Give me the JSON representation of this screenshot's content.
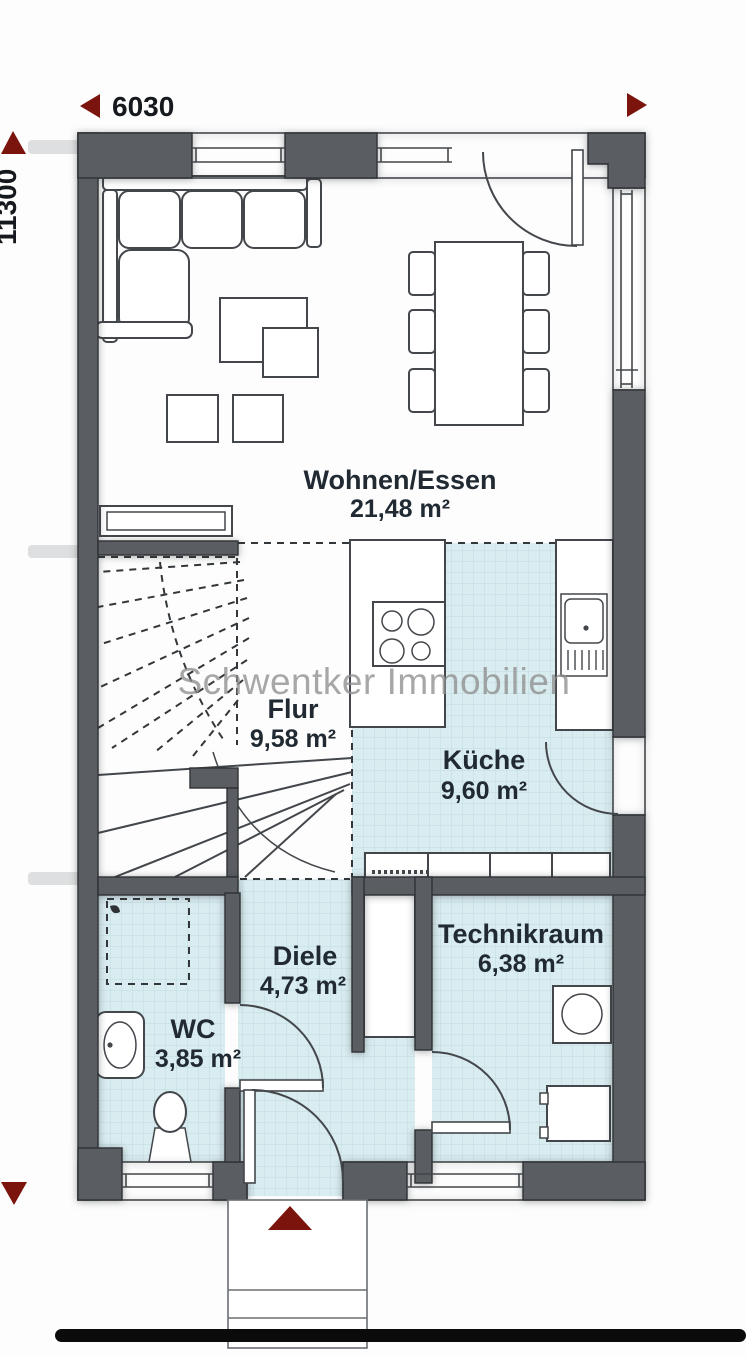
{
  "plan": {
    "type": "floor-plan",
    "watermark": "Schwentker Immobilien"
  },
  "dimensions": {
    "width_label": "6030",
    "height_label": "11300"
  },
  "rooms": [
    {
      "id": "wohnen-essen",
      "name": "Wohnen/Essen",
      "area": "21,48 m²",
      "floor": "white"
    },
    {
      "id": "flur",
      "name": "Flur",
      "area": "9,58 m²",
      "floor": "white"
    },
    {
      "id": "kueche",
      "name": "Küche",
      "area": "9,60 m²",
      "floor": "tile"
    },
    {
      "id": "diele",
      "name": "Diele",
      "area": "4,73 m²",
      "floor": "tile"
    },
    {
      "id": "technikraum",
      "name": "Technikraum",
      "area": "6,38 m²",
      "floor": "tile"
    },
    {
      "id": "wc",
      "name": "WC",
      "area": "3,85 m²",
      "floor": "tile"
    }
  ],
  "furniture_symbols": [
    "corner-sofa",
    "coffee-tables",
    "stools",
    "sideboard",
    "dining-table-six-chairs",
    "kitchen-island-cooktop",
    "kitchen-sink-counter",
    "kitchen-base-cabinets",
    "winder-staircase",
    "shower-area",
    "washbasin",
    "toilet",
    "washing-machine",
    "technical-appliance",
    "entrance-steps"
  ],
  "colors": {
    "wall": "#5a5e63",
    "tile": "#d9ecf0",
    "tile_grid": "#bedae1",
    "arrow_red": "#7a140c",
    "label_text": "#212a33",
    "watermark": "#8f8f8f",
    "baseline": "#0b0b0b"
  }
}
